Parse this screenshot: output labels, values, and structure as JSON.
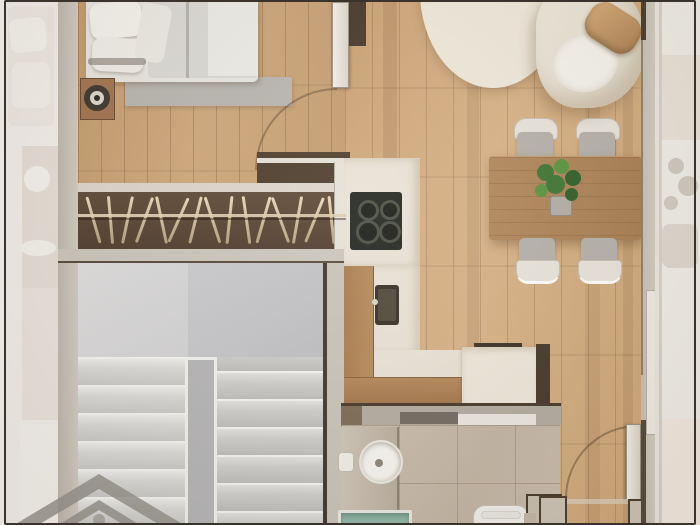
{
  "title": "apartment-floor-plan-render",
  "description": "Top-down 3D rendered floor plan of a small apartment, no visible text",
  "palette": {
    "floor_living": "#d0a87a",
    "floor_bedroom": "#c49c6e",
    "wall_greige": "#ccc6bb",
    "wall_dark_brown": "#46382a",
    "wardrobe_brown": "#554231",
    "stair_grey": "#d6d6d8",
    "tile_beige": "#c7b9aa",
    "shower_teal": "#8fb7a9",
    "cooktop_black": "#20231e",
    "rug_cream": "#eae3d4",
    "sofa_cream": "#e9e4d8",
    "pillow_tan": "#c5a173",
    "table_wood": "#ad8257",
    "plant_green": "#4a7d34",
    "watermark_grey": "#95938d"
  },
  "rooms": [
    {
      "name": "bedroom",
      "furniture": [
        "double-bed",
        "pillows",
        "grey-foot-rug",
        "nightstand",
        "table-lamp"
      ]
    },
    {
      "name": "wardrobe",
      "furniture": [
        "hanging-rail",
        "clothes-hangers"
      ]
    },
    {
      "name": "staircase",
      "furniture": [
        "upper-landing",
        "left-flight",
        "right-flight",
        "center-stringer"
      ]
    },
    {
      "name": "living-dining",
      "furniture": [
        "round-cream-rug",
        "curved-sofa",
        "tan-throw-pillow",
        "dining-table",
        "four-dining-chairs",
        "potted-plant"
      ]
    },
    {
      "name": "kitchen",
      "furniture": [
        "l-shaped-counter",
        "four-burner-cooktop",
        "sink",
        "island-cabinet"
      ]
    },
    {
      "name": "bathroom",
      "furniture": [
        "vanity-counter",
        "round-basin",
        "soap-dish",
        "toilet",
        "teal-shower-tray"
      ]
    },
    {
      "name": "entry",
      "furniture": [
        "entry-door-open"
      ]
    }
  ],
  "doors": [
    {
      "room": "bedroom",
      "state": "open",
      "swing": "quarter-arc"
    },
    {
      "room": "entry",
      "state": "open",
      "swing": "quarter-arc"
    }
  ],
  "watermark": {
    "shape": "double-chevron-house-logo",
    "position": "bottom-left"
  },
  "closet": {
    "start": 14,
    "spacing": 17,
    "hanger_angles": [
      -16,
      -5,
      12,
      20,
      -12,
      24,
      14,
      -18,
      6,
      -8,
      16,
      -20,
      10,
      22,
      -6
    ]
  },
  "stairs": {
    "step_height": 28,
    "flights": [
      {
        "id": "left",
        "steps": 6,
        "offset": 0,
        "tone": "light"
      },
      {
        "id": "right",
        "steps": 7,
        "offset": -14,
        "tone": "dark"
      }
    ]
  },
  "kitchen": {
    "cooktop_burners": [
      {
        "x": 8,
        "y": 8,
        "d": 15
      },
      {
        "x": 30,
        "y": 8,
        "d": 14
      },
      {
        "x": 6,
        "y": 28,
        "d": 18
      },
      {
        "x": 29,
        "y": 29,
        "d": 16
      }
    ]
  },
  "living_floor_accent_planks": [
    {
      "x": 38,
      "w": 14,
      "a": 0.18
    },
    {
      "x": 122,
      "w": 12,
      "a": 0.14
    },
    {
      "x": 240,
      "w": 15,
      "a": 0.12
    },
    {
      "x": 278,
      "w": 10,
      "a": 0.15
    }
  ],
  "dining_plant_leaves": [
    {
      "x": -16,
      "y": -26,
      "d": 17
    },
    {
      "x": 0,
      "y": -32,
      "d": 15
    },
    {
      "x": 12,
      "y": -20,
      "d": 16
    },
    {
      "x": -6,
      "y": -14,
      "d": 19
    },
    {
      "x": -20,
      "y": -8,
      "d": 13
    },
    {
      "x": 10,
      "y": -4,
      "d": 13
    }
  ],
  "leaf_colors": [
    "#3f7434",
    "#58933f",
    "#2f5e29"
  ]
}
